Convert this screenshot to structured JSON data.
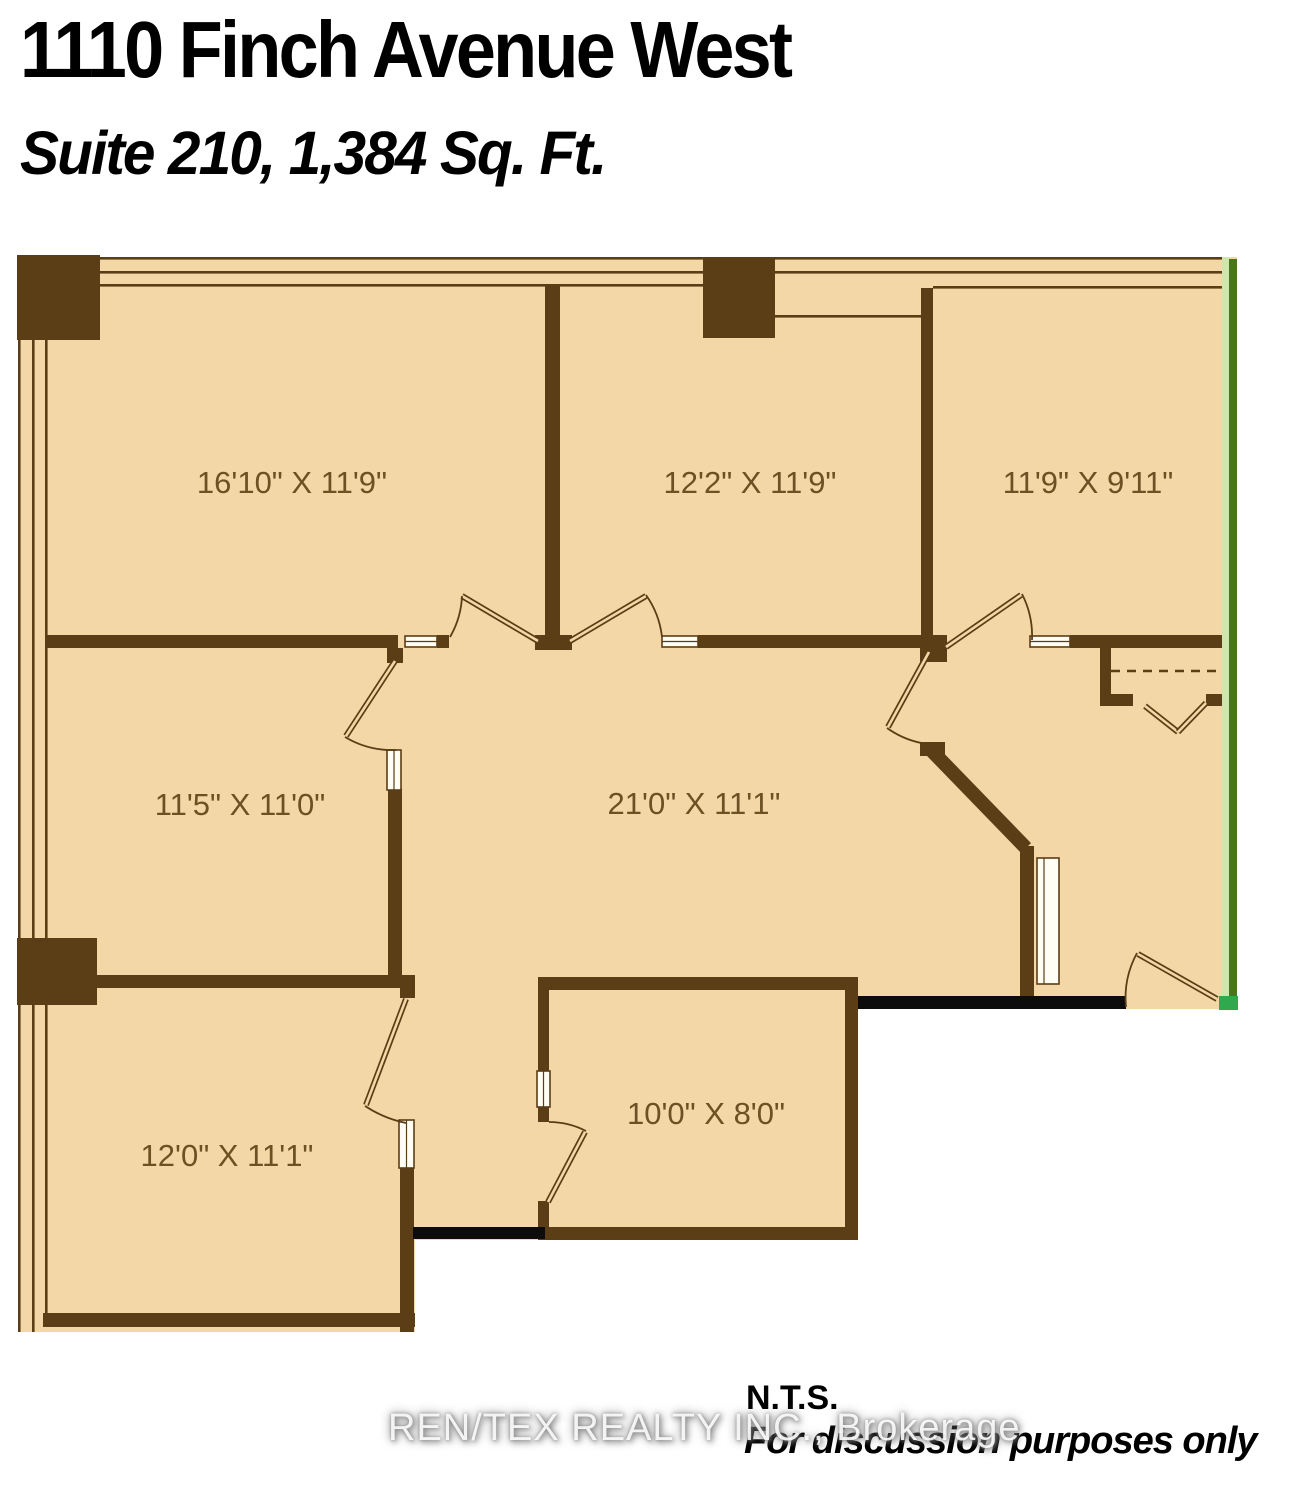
{
  "header": {
    "title": "1110 Finch Avenue West",
    "subtitle": "Suite 210, 1,384 Sq. Ft."
  },
  "rooms": [
    {
      "id": "room-top-left",
      "label": "16'10\" X 11'9\""
    },
    {
      "id": "room-top-middle",
      "label": "12'2\" X 11'9\""
    },
    {
      "id": "room-top-right",
      "label": "11'9\" X 9'11\""
    },
    {
      "id": "room-mid-left",
      "label": "11'5\" X 11'0\""
    },
    {
      "id": "room-corridor",
      "label": "21'0\" X 11'1\""
    },
    {
      "id": "room-bottom-left",
      "label": "12'0\" X 11'1\""
    },
    {
      "id": "room-bottom-middle",
      "label": "10'0\" X 8'0\""
    }
  ],
  "footer": {
    "nts": "N.T.S.",
    "note": "For discussion purposes only"
  },
  "watermark": {
    "text": "REN/TEX REALTY INC., Brokerage"
  },
  "colors": {
    "floor": "#f4d7a6",
    "wall": "#5b3d16",
    "label": "#6b5124",
    "window_wall_light": "#cfe7ae",
    "window_wall_dark": "#47761d",
    "window_wall_accent": "#2fa84e",
    "demising_wall": "#0c0c0c"
  }
}
